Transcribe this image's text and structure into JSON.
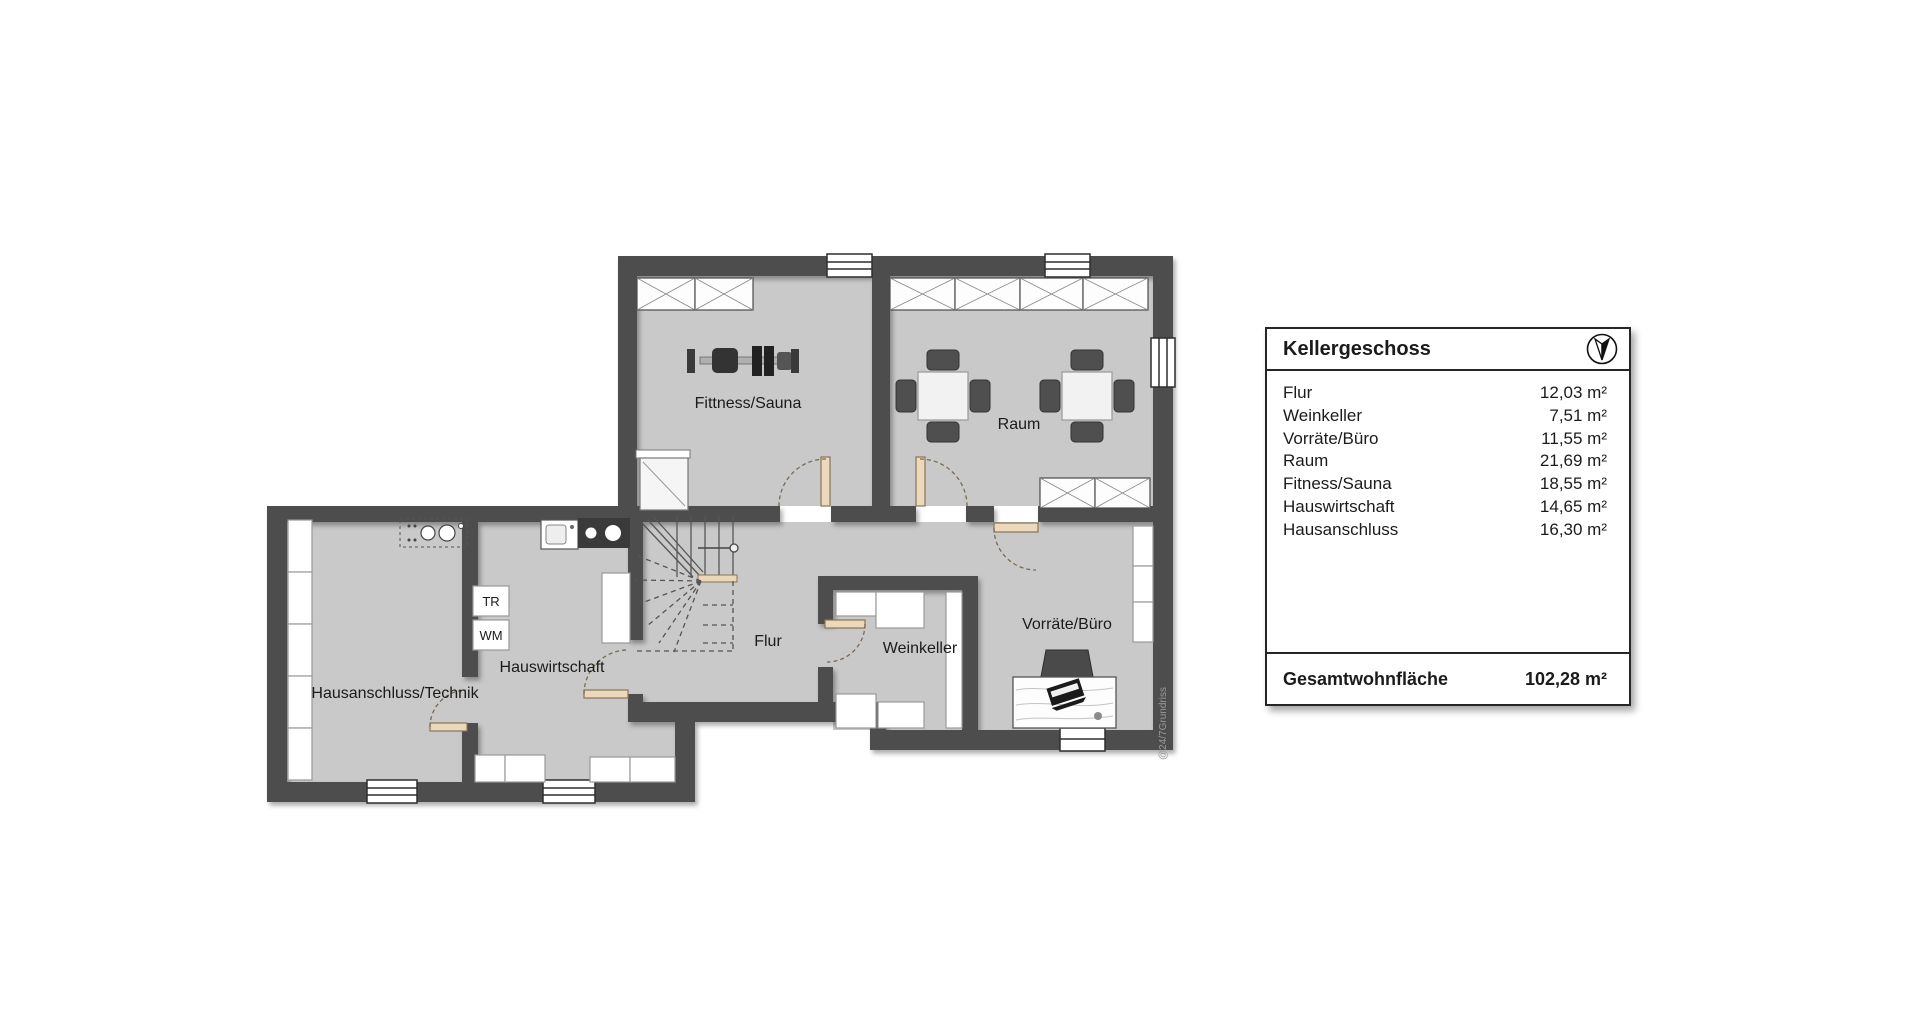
{
  "legend": {
    "title": "Kellergeschoss",
    "rows": [
      {
        "name": "Flur",
        "area": "12,03 m²"
      },
      {
        "name": "Weinkeller",
        "area": "7,51 m²"
      },
      {
        "name": "Vorräte/Büro",
        "area": "11,55 m²"
      },
      {
        "name": "Raum",
        "area": "21,69 m²"
      },
      {
        "name": "Fitness/Sauna",
        "area": "18,55 m²"
      },
      {
        "name": "Hauswirtschaft",
        "area": "14,65 m²"
      },
      {
        "name": "Hausanschluss",
        "area": "16,30 m²"
      }
    ],
    "total_label": "Gesamtwohnfläche",
    "total_area": "102,28 m²"
  },
  "floor_plan": {
    "labels": {
      "fitness_sauna": "Fittness/Sauna",
      "raum": "Raum",
      "hausanschluss": "Hausanschluss/Technik",
      "hauswirtschaft": "Hauswirtschaft",
      "flur": "Flur",
      "weinkeller": "Weinkeller",
      "vorraete_buero": "Vorräte/Büro",
      "dryer_abbr": "TR",
      "washer_abbr": "WM"
    },
    "watermark": "@24/7Grundriss",
    "colors": {
      "wall": "#4d4d4d",
      "floor": "#c9c9c9",
      "door_leaf": "#ecd9bc"
    }
  }
}
